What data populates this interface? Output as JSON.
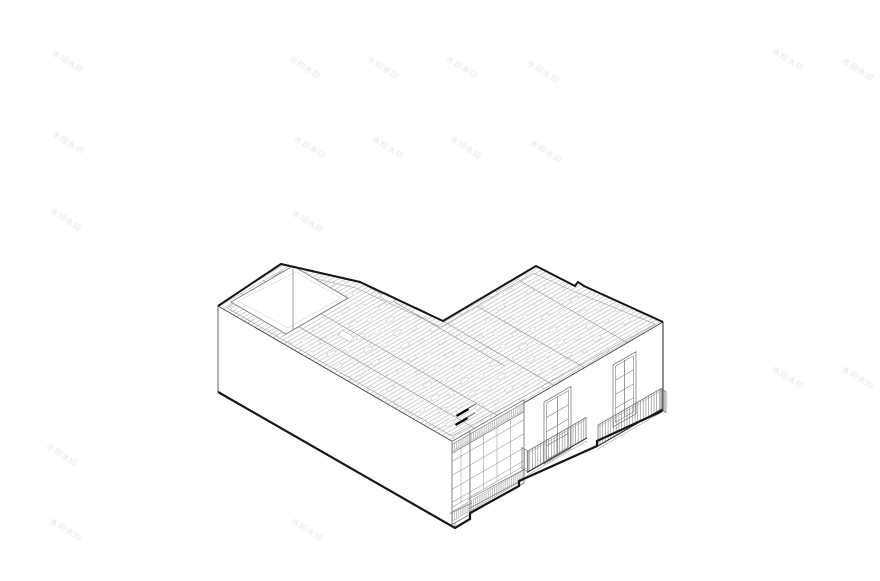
{
  "canvas": {
    "width_px": 880,
    "height_px": 581,
    "background": "#ffffff"
  },
  "watermark": {
    "text": "水印水印",
    "color": "#e6e6e6",
    "font_size_px": 8,
    "rotation_deg": 33,
    "positions": [
      [
        68,
        62
      ],
      [
        305,
        68
      ],
      [
        383,
        68
      ],
      [
        462,
        68
      ],
      [
        543,
        72
      ],
      [
        788,
        60
      ],
      [
        858,
        70
      ],
      [
        68,
        143
      ],
      [
        310,
        148
      ],
      [
        388,
        148
      ],
      [
        466,
        148
      ],
      [
        546,
        152
      ],
      [
        66,
        220
      ],
      [
        308,
        222
      ],
      [
        788,
        378
      ],
      [
        858,
        378
      ],
      [
        62,
        455
      ],
      [
        391,
        453
      ],
      [
        66,
        530
      ],
      [
        307,
        530
      ]
    ]
  },
  "drawing": {
    "subject": "axonometric cutaway of L-shaped building with exposed roof joists, corner glazed bay window, balconies and rear patio opening",
    "ink_color": "#161616",
    "edge_color": "#555555",
    "detail_color": "#8a8a8a",
    "joist_color": "#b8b8b8",
    "counts": {
      "facade_windows": 2,
      "balconies": 2,
      "bay_window_pane_columns": 4,
      "bay_window_pane_rows": 5,
      "window_pane_columns": 2,
      "window_pane_rows": 4,
      "patio_openings": 1,
      "black_arrow_marks": 2
    }
  }
}
